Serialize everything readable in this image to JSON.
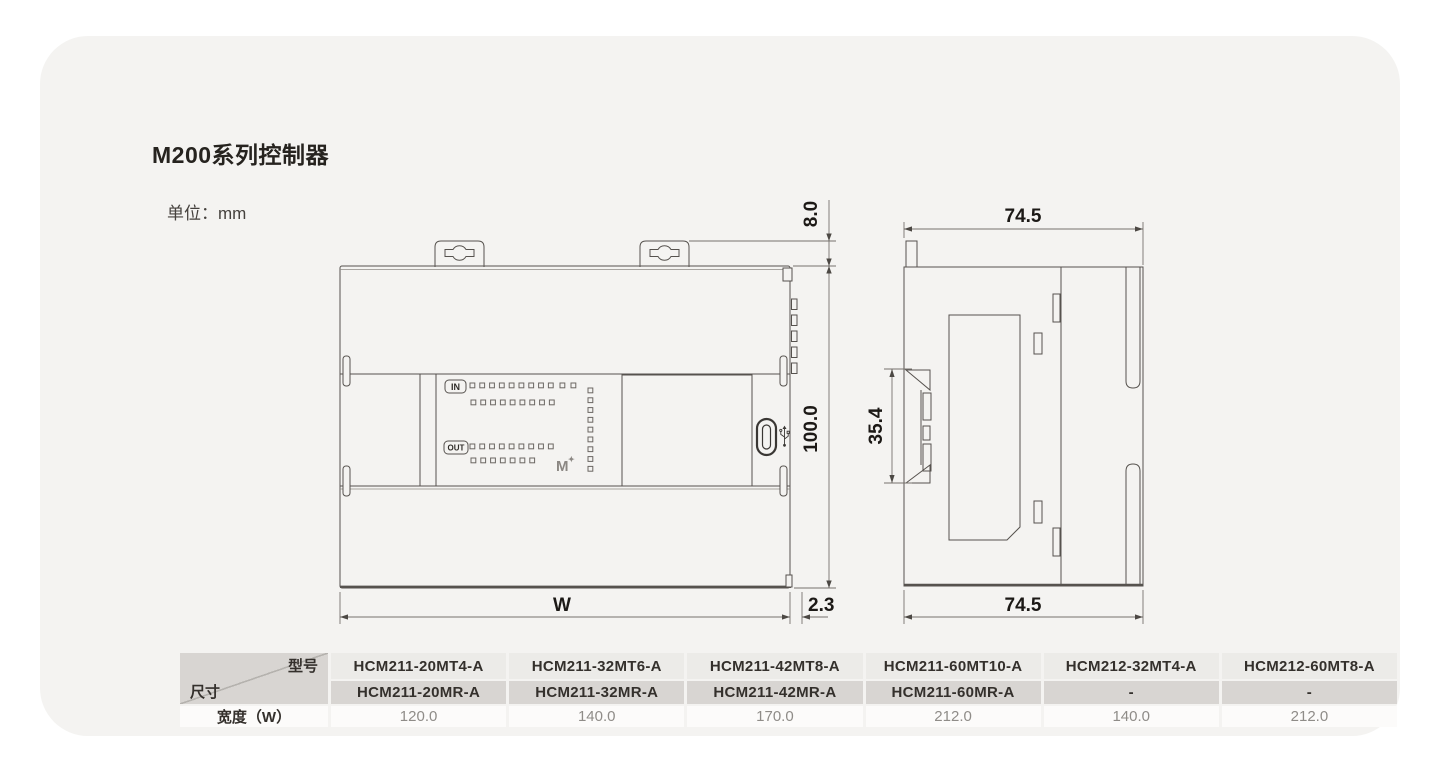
{
  "page": {
    "title": "M200系列控制器",
    "unit_label": "单位：mm"
  },
  "front_view": {
    "panel": {
      "in_label": "IN",
      "out_label": "OUT",
      "logo": "M",
      "logo_spark": "✦"
    },
    "leds": {
      "in_row1": 9,
      "in_row1_extra": 2,
      "in_row2": 9,
      "out_row1": 9,
      "out_row2": 7,
      "side_column": 9
    },
    "dims": {
      "tab_height": "8.0",
      "body_height": "100.0",
      "width": "W",
      "rail_offset": "2.3"
    }
  },
  "side_view": {
    "dims": {
      "width_top": "74.5",
      "width_bottom": "74.5",
      "clip_height": "35.4"
    }
  },
  "table": {
    "corner_top": "型号",
    "corner_bottom": "尺寸",
    "row_label": "宽度（W）",
    "columns": [
      {
        "mt": "HCM211-20MT4-A",
        "mr": "HCM211-20MR-A",
        "w": "120.0"
      },
      {
        "mt": "HCM211-32MT6-A",
        "mr": "HCM211-32MR-A",
        "w": "140.0"
      },
      {
        "mt": "HCM211-42MT8-A",
        "mr": "HCM211-42MR-A",
        "w": "170.0"
      },
      {
        "mt": "HCM211-60MT10-A",
        "mr": "HCM211-60MR-A",
        "w": "212.0"
      },
      {
        "mt": "HCM212-32MT4-A",
        "mr": "-",
        "w": "140.0"
      },
      {
        "mt": "HCM212-60MT8-A",
        "mr": "-",
        "w": "212.0"
      }
    ]
  },
  "colors": {
    "card_bg": "#f4f3f1",
    "stroke": "#56524e",
    "dim_line": "#76726d",
    "header_gray": "#d8d5d2",
    "row_light": "#ecebe8",
    "row_white": "#fcfbfa"
  }
}
